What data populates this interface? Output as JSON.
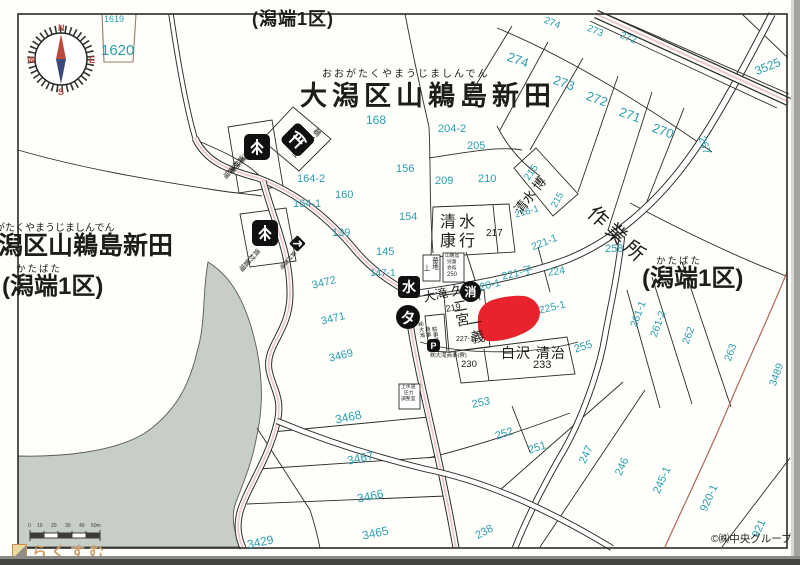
{
  "map": {
    "top": {
      "paren": "(潟端1区)",
      "furigana": "おおがたくやまうじましんでん",
      "title": "大潟区山鵜島新田"
    },
    "left": {
      "furigana": "おおがたくやまうじましんでん",
      "title": "大潟区山鵜島新田",
      "paren_furigana": "かたばた",
      "paren": "(潟端1区)"
    },
    "right": {
      "paren_furigana": "かたばた",
      "paren": "(潟端1区)"
    },
    "compass": {
      "n": "N",
      "e": "E",
      "s": "S",
      "w": "W"
    },
    "scale": {
      "ticks": [
        {
          "t": "0",
          "x": 28
        },
        {
          "t": "10",
          "x": 37
        },
        {
          "t": "20",
          "x": 51
        },
        {
          "t": "30",
          "x": 65
        },
        {
          "t": "40",
          "x": 79
        },
        {
          "t": "50m",
          "x": 91
        }
      ]
    },
    "logo": {
      "text": "らくすむ"
    },
    "copyright": "©㈱中央グループ",
    "badges": [
      {
        "n": "water-supply-badge",
        "label": "水",
        "x": 398,
        "y": 276,
        "d": 22,
        "shape": "square",
        "fs": 14
      },
      {
        "n": "fire-hydrant-badge",
        "label": "消",
        "x": 460,
        "y": 281,
        "d": 21,
        "shape": "circle",
        "fs": 12
      },
      {
        "n": "taxi-badge",
        "label": "タ",
        "x": 396,
        "y": 305,
        "d": 24,
        "shape": "circle",
        "fs": 15
      },
      {
        "n": "parking-badge",
        "label": "P",
        "x": 427,
        "y": 339,
        "d": 13,
        "shape": "square",
        "fs": 9
      }
    ],
    "labels": [
      {
        "n": "parcel-1619",
        "t": "1619",
        "x": 104,
        "y": 15,
        "s": 9
      },
      {
        "n": "parcel-1620",
        "t": "1620",
        "x": 101,
        "y": 43,
        "s": 15
      },
      {
        "n": "parcel-274-top",
        "t": "274",
        "x": 546,
        "y": 16,
        "s": 10,
        "r": 22
      },
      {
        "n": "parcel-273-top",
        "t": "273",
        "x": 589,
        "y": 24,
        "s": 10,
        "r": 22
      },
      {
        "n": "parcel-272-top",
        "t": "272",
        "x": 622,
        "y": 31,
        "s": 10,
        "r": 22
      },
      {
        "n": "parcel-3525",
        "t": "3525",
        "x": 753,
        "y": 66,
        "s": 12,
        "r": -22
      },
      {
        "n": "parcel-274",
        "t": "274",
        "x": 510,
        "y": 50,
        "s": 13,
        "r": 20
      },
      {
        "n": "parcel-273",
        "t": "273",
        "x": 556,
        "y": 73,
        "s": 13,
        "r": 20
      },
      {
        "n": "parcel-272",
        "t": "272",
        "x": 589,
        "y": 89,
        "s": 13,
        "r": 20
      },
      {
        "n": "parcel-271",
        "t": "271",
        "x": 622,
        "y": 105,
        "s": 13,
        "r": 20
      },
      {
        "n": "parcel-270",
        "t": "270",
        "x": 655,
        "y": 121,
        "s": 13,
        "r": 20
      },
      {
        "n": "parcel-267",
        "t": "267",
        "x": 706,
        "y": 135,
        "s": 11,
        "r": 72
      },
      {
        "n": "parcel-168",
        "t": "168",
        "x": 366,
        "y": 114,
        "s": 12
      },
      {
        "n": "parcel-204-2",
        "t": "204-2",
        "x": 438,
        "y": 124,
        "s": 11
      },
      {
        "n": "parcel-205",
        "t": "205",
        "x": 467,
        "y": 141,
        "s": 11
      },
      {
        "n": "parcel-156",
        "t": "156",
        "x": 396,
        "y": 164,
        "s": 11
      },
      {
        "n": "parcel-209",
        "t": "209",
        "x": 435,
        "y": 176,
        "s": 11
      },
      {
        "n": "parcel-210",
        "t": "210",
        "x": 478,
        "y": 174,
        "s": 11
      },
      {
        "n": "parcel-215-upper",
        "t": "215",
        "x": 523,
        "y": 177,
        "s": 10,
        "r": -55
      },
      {
        "n": "parcel-216-1",
        "t": "216-1",
        "x": 514,
        "y": 211,
        "s": 9.5,
        "r": -16
      },
      {
        "n": "parcel-215",
        "t": "215",
        "x": 550,
        "y": 205,
        "s": 9.5,
        "r": -62
      },
      {
        "n": "parcel-164-2",
        "t": "164-2",
        "x": 297,
        "y": 174,
        "s": 11
      },
      {
        "n": "parcel-160",
        "t": "160",
        "x": 335,
        "y": 190,
        "s": 11
      },
      {
        "n": "parcel-164-1",
        "t": "164-1",
        "x": 293,
        "y": 199,
        "s": 11
      },
      {
        "n": "parcel-139",
        "t": "139",
        "x": 332,
        "y": 228,
        "s": 11
      },
      {
        "n": "parcel-154",
        "t": "154",
        "x": 399,
        "y": 212,
        "s": 11
      },
      {
        "n": "parcel-145",
        "t": "145",
        "x": 376,
        "y": 247,
        "s": 11
      },
      {
        "n": "parcel-147-1",
        "t": "147-1",
        "x": 370,
        "y": 269,
        "s": 10
      },
      {
        "n": "parcel-217",
        "t": "217",
        "x": 486,
        "y": 229,
        "s": 10,
        "c": "k"
      },
      {
        "n": "parcel-3472",
        "t": "3472",
        "x": 311,
        "y": 281,
        "s": 11,
        "r": -14
      },
      {
        "n": "parcel-3471",
        "t": "3471",
        "x": 320,
        "y": 317,
        "s": 11,
        "r": -14
      },
      {
        "n": "parcel-3469",
        "t": "3469",
        "x": 328,
        "y": 354,
        "s": 11,
        "r": -14
      },
      {
        "n": "parcel-221-1",
        "t": "221-1",
        "x": 530,
        "y": 243,
        "s": 10.5,
        "r": -22
      },
      {
        "n": "parcel-221-ko",
        "t": "221-子",
        "x": 501,
        "y": 272,
        "s": 10.5,
        "r": -13
      },
      {
        "n": "parcel-220-1",
        "t": "220-1",
        "x": 473,
        "y": 284,
        "s": 10.5,
        "r": -13
      },
      {
        "n": "parcel-224",
        "t": "224",
        "x": 547,
        "y": 268,
        "s": 10.5,
        "r": -8
      },
      {
        "n": "parcel-225-1",
        "t": "225-1",
        "x": 538,
        "y": 306,
        "s": 10.5,
        "r": -14
      },
      {
        "n": "parcel-258",
        "t": "258",
        "x": 605,
        "y": 244,
        "s": 11
      },
      {
        "n": "parcel-255",
        "t": "255",
        "x": 573,
        "y": 345,
        "s": 11,
        "r": -18
      },
      {
        "n": "parcel-261-1",
        "t": "261-1",
        "x": 629,
        "y": 325,
        "s": 10.5,
        "r": -70
      },
      {
        "n": "parcel-261-2",
        "t": "261-2",
        "x": 649,
        "y": 335,
        "s": 10.5,
        "r": -70
      },
      {
        "n": "parcel-262",
        "t": "262",
        "x": 681,
        "y": 342,
        "s": 10.5,
        "r": -70
      },
      {
        "n": "parcel-263",
        "t": "263",
        "x": 723,
        "y": 359,
        "s": 10.5,
        "r": -70
      },
      {
        "n": "parcel-3489",
        "t": "3489",
        "x": 768,
        "y": 384,
        "s": 10.5,
        "r": -70
      },
      {
        "n": "parcel-253",
        "t": "253",
        "x": 471,
        "y": 400,
        "s": 11,
        "r": -12
      },
      {
        "n": "parcel-3468",
        "t": "3468",
        "x": 334,
        "y": 414,
        "s": 12,
        "r": -12
      },
      {
        "n": "parcel-3467",
        "t": "3467",
        "x": 346,
        "y": 455,
        "s": 12,
        "r": -12
      },
      {
        "n": "parcel-3466",
        "t": "3466",
        "x": 356,
        "y": 493,
        "s": 12,
        "r": -12
      },
      {
        "n": "parcel-3465",
        "t": "3465",
        "x": 361,
        "y": 530,
        "s": 12,
        "r": -12
      },
      {
        "n": "parcel-3429",
        "t": "3429",
        "x": 246,
        "y": 539,
        "s": 12,
        "r": -12
      },
      {
        "n": "parcel-238",
        "t": "238",
        "x": 474,
        "y": 532,
        "s": 11,
        "r": -28
      },
      {
        "n": "parcel-252",
        "t": "252",
        "x": 494,
        "y": 432,
        "s": 11,
        "r": -18
      },
      {
        "n": "parcel-251",
        "t": "251",
        "x": 527,
        "y": 446,
        "s": 11,
        "r": -18
      },
      {
        "n": "parcel-247",
        "t": "247",
        "x": 578,
        "y": 461,
        "s": 11,
        "r": -66
      },
      {
        "n": "parcel-246",
        "t": "246",
        "x": 614,
        "y": 473,
        "s": 11,
        "r": -66
      },
      {
        "n": "parcel-245-1",
        "t": "245-1",
        "x": 652,
        "y": 491,
        "s": 11,
        "r": -66
      },
      {
        "n": "parcel-920-1",
        "t": "920-1",
        "x": 699,
        "y": 509,
        "s": 11,
        "r": -66
      },
      {
        "n": "parcel-921",
        "t": "921",
        "x": 751,
        "y": 535,
        "s": 11,
        "r": -66
      },
      {
        "n": "parcel-219",
        "t": "219",
        "x": 445,
        "y": 305,
        "s": 9,
        "c": "k",
        "r": -10
      },
      {
        "n": "parcel-227-1",
        "t": "227-1",
        "x": 456,
        "y": 336,
        "s": 7,
        "c": "k"
      },
      {
        "n": "parcel-233",
        "t": "233",
        "x": 533,
        "y": 360,
        "s": 11,
        "c": "k"
      },
      {
        "n": "parcel-230",
        "t": "230",
        "x": 461,
        "y": 360,
        "s": 9.5,
        "c": "k"
      },
      {
        "n": "owner-shimizu-yasuyuki",
        "t": "清水\n康行",
        "x": 440,
        "y": 213,
        "s": 16,
        "c": "k",
        "ls": 3,
        "lh": 1.2
      },
      {
        "n": "owner-shimizu-hiroshi",
        "t": "清水 博",
        "x": 512,
        "y": 208,
        "s": 13,
        "c": "k",
        "r": -52
      },
      {
        "n": "owner-otaki-hisao",
        "t": "大滝 久男",
        "x": 422,
        "y": 292,
        "s": 12.5,
        "c": "k",
        "r": -12
      },
      {
        "n": "owner-ninomiya-col1",
        "t": "二宮",
        "x": 452,
        "y": 300,
        "s": 14,
        "c": "k",
        "v": 1,
        "r": -10
      },
      {
        "n": "owner-ninomiya-col2",
        "t": "一義",
        "x": 467,
        "y": 317,
        "s": 14,
        "c": "k",
        "v": 1,
        "r": -10
      },
      {
        "n": "owner-shirasawa-seiji",
        "t": "白沢 清治",
        "x": 501,
        "y": 346,
        "s": 14,
        "c": "k",
        "ls": 1
      },
      {
        "n": "workshop-label",
        "t": "作業所",
        "x": 597,
        "y": 203,
        "s": 20,
        "c": "k",
        "r": 43,
        "ls": 5
      },
      {
        "n": "otaki-dorm-note",
        "t": "㈱大滝商事(寮)",
        "x": 430,
        "y": 354,
        "s": 5.5,
        "c": "k"
      },
      {
        "n": "cemetery-label",
        "t": "墓地",
        "x": 430,
        "y": 257,
        "s": 6.5,
        "c": "k",
        "v": 1
      },
      {
        "n": "cemetery-symbol",
        "t": "⊥",
        "x": 423,
        "y": 264,
        "s": 9,
        "c": "k"
      },
      {
        "n": "hall-line1",
        "t": "山鵜島",
        "x": 445,
        "y": 255,
        "s": 4.8,
        "c": "k"
      },
      {
        "n": "hall-line2",
        "t": "児童",
        "x": 447,
        "y": 261,
        "s": 4.8,
        "c": "k"
      },
      {
        "n": "hall-line3",
        "t": "会館",
        "x": 447,
        "y": 267,
        "s": 4.8,
        "c": "k"
      },
      {
        "n": "hall-number-250",
        "t": "250",
        "x": 447,
        "y": 272,
        "s": 6,
        "c": "k"
      },
      {
        "n": "waterworks-line1",
        "t": "上水道",
        "x": 401,
        "y": 386,
        "s": 4.8,
        "c": "k"
      },
      {
        "n": "waterworks-line2",
        "t": "圧力",
        "x": 404,
        "y": 392,
        "s": 4.8,
        "c": "k"
      },
      {
        "n": "waterworks-line3",
        "t": "調整室",
        "x": 401,
        "y": 398,
        "s": 4.8,
        "c": "k"
      },
      {
        "n": "parking-note-1",
        "t": "㈱大滝",
        "x": 416,
        "y": 322,
        "s": 5.5,
        "c": "k",
        "v": 1,
        "r": -8
      },
      {
        "n": "parking-note-2",
        "t": "商事",
        "x": 423,
        "y": 327,
        "s": 5.5,
        "c": "k",
        "v": 1,
        "r": -8
      },
      {
        "n": "parking-note-3",
        "t": "駐車場",
        "x": 430,
        "y": 327,
        "s": 5.5,
        "c": "k",
        "v": 1,
        "r": -8
      },
      {
        "n": "yard-upper-note-1",
        "t": "㈱大滝商事",
        "x": 251,
        "y": 144,
        "s": 7,
        "c": "k",
        "v": 1,
        "r": 42
      },
      {
        "n": "yard-upper-note-2",
        "t": "資材置場",
        "x": 240,
        "y": 154,
        "s": 7,
        "c": "k",
        "v": 1,
        "r": 42
      },
      {
        "n": "shrine-name",
        "t": "鵜ノ島神社",
        "x": 317,
        "y": 127,
        "s": 7.5,
        "c": "k",
        "v": 1,
        "r": 45
      },
      {
        "n": "yard-lower-note",
        "t": "資材置場",
        "x": 256,
        "y": 247,
        "s": 7,
        "c": "k",
        "v": 1,
        "r": 42
      },
      {
        "n": "yard-small-note",
        "t": "資材置場",
        "x": 292,
        "y": 249,
        "s": 5.5,
        "c": "k",
        "v": 1,
        "r": 42
      }
    ]
  },
  "colors": {
    "teal": "#2a9fb1",
    "ink": "#1d1d1b",
    "highlight_red": "#e8232d",
    "road_pink": "#eec7ca",
    "lake_gray": "#c7cdc7",
    "line": "#2b2b28",
    "boundary_red": "#b06a58",
    "logo_orange": "#cfa06a",
    "compass_red": "#bb4a3c",
    "needle_blue": "#3a4a7a"
  }
}
